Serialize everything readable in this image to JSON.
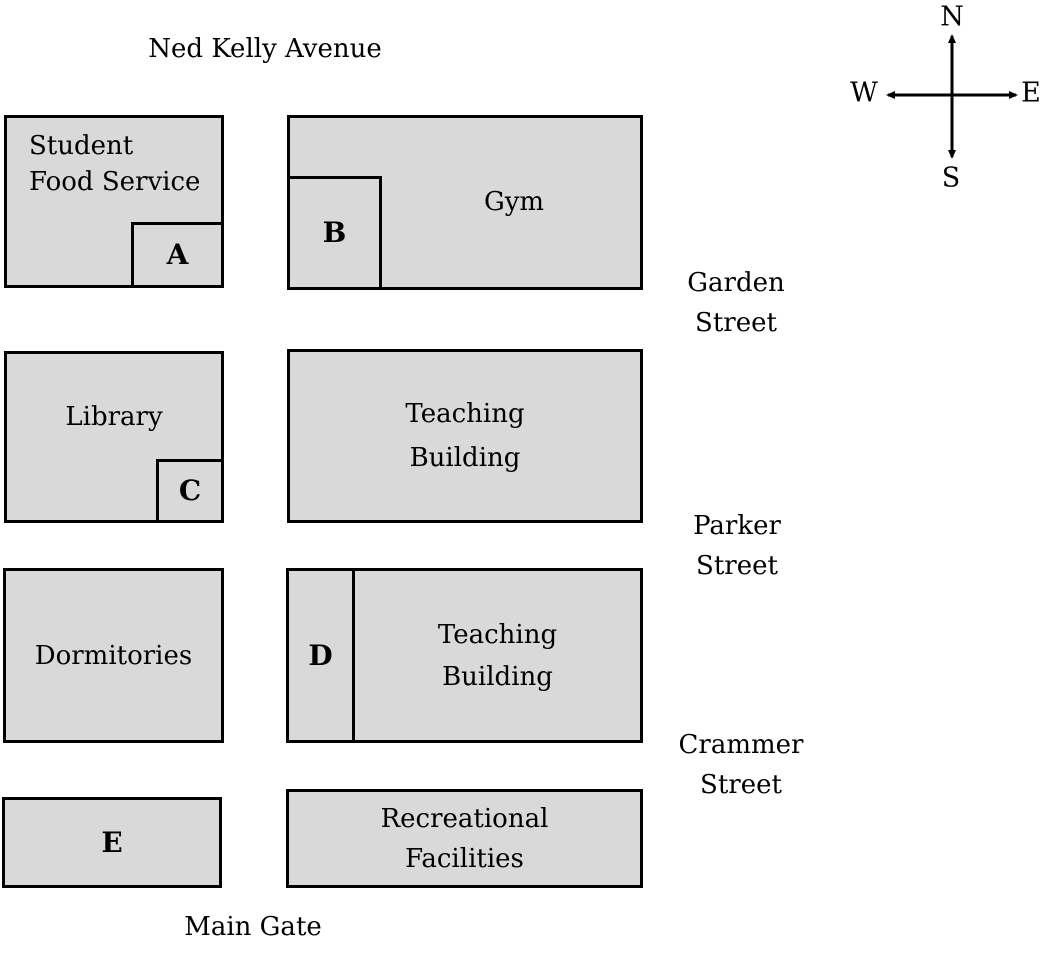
{
  "map": {
    "avenue_label": "Ned Kelly Avenue",
    "main_gate_label": "Main Gate",
    "streets": {
      "garden": {
        "line1": "Garden",
        "line2": "Street"
      },
      "parker": {
        "line1": "Parker",
        "line2": "Street"
      },
      "crammer": {
        "line1": "Crammer",
        "line2": "Street"
      }
    },
    "buildings": {
      "student_food_service": {
        "line1": "Student",
        "line2": "Food Service",
        "annex": "A"
      },
      "gym": {
        "label": "Gym",
        "annex": "B"
      },
      "library": {
        "label": "Library",
        "annex": "C"
      },
      "teaching_building_north": {
        "line1": "Teaching",
        "line2": "Building"
      },
      "dormitories": {
        "label": "Dormitories"
      },
      "teaching_building_south": {
        "line1": "Teaching",
        "line2": "Building",
        "annex": "D"
      },
      "building_e": {
        "annex": "E"
      },
      "recreational_facilities": {
        "line1": "Recreational",
        "line2": "Facilities"
      }
    },
    "compass": {
      "north": "N",
      "south": "S",
      "west": "W",
      "east": "E"
    },
    "colors": {
      "building_fill": "#d9d9d9",
      "outline": "#000000",
      "text": "#000000",
      "background": "#ffffff"
    }
  }
}
